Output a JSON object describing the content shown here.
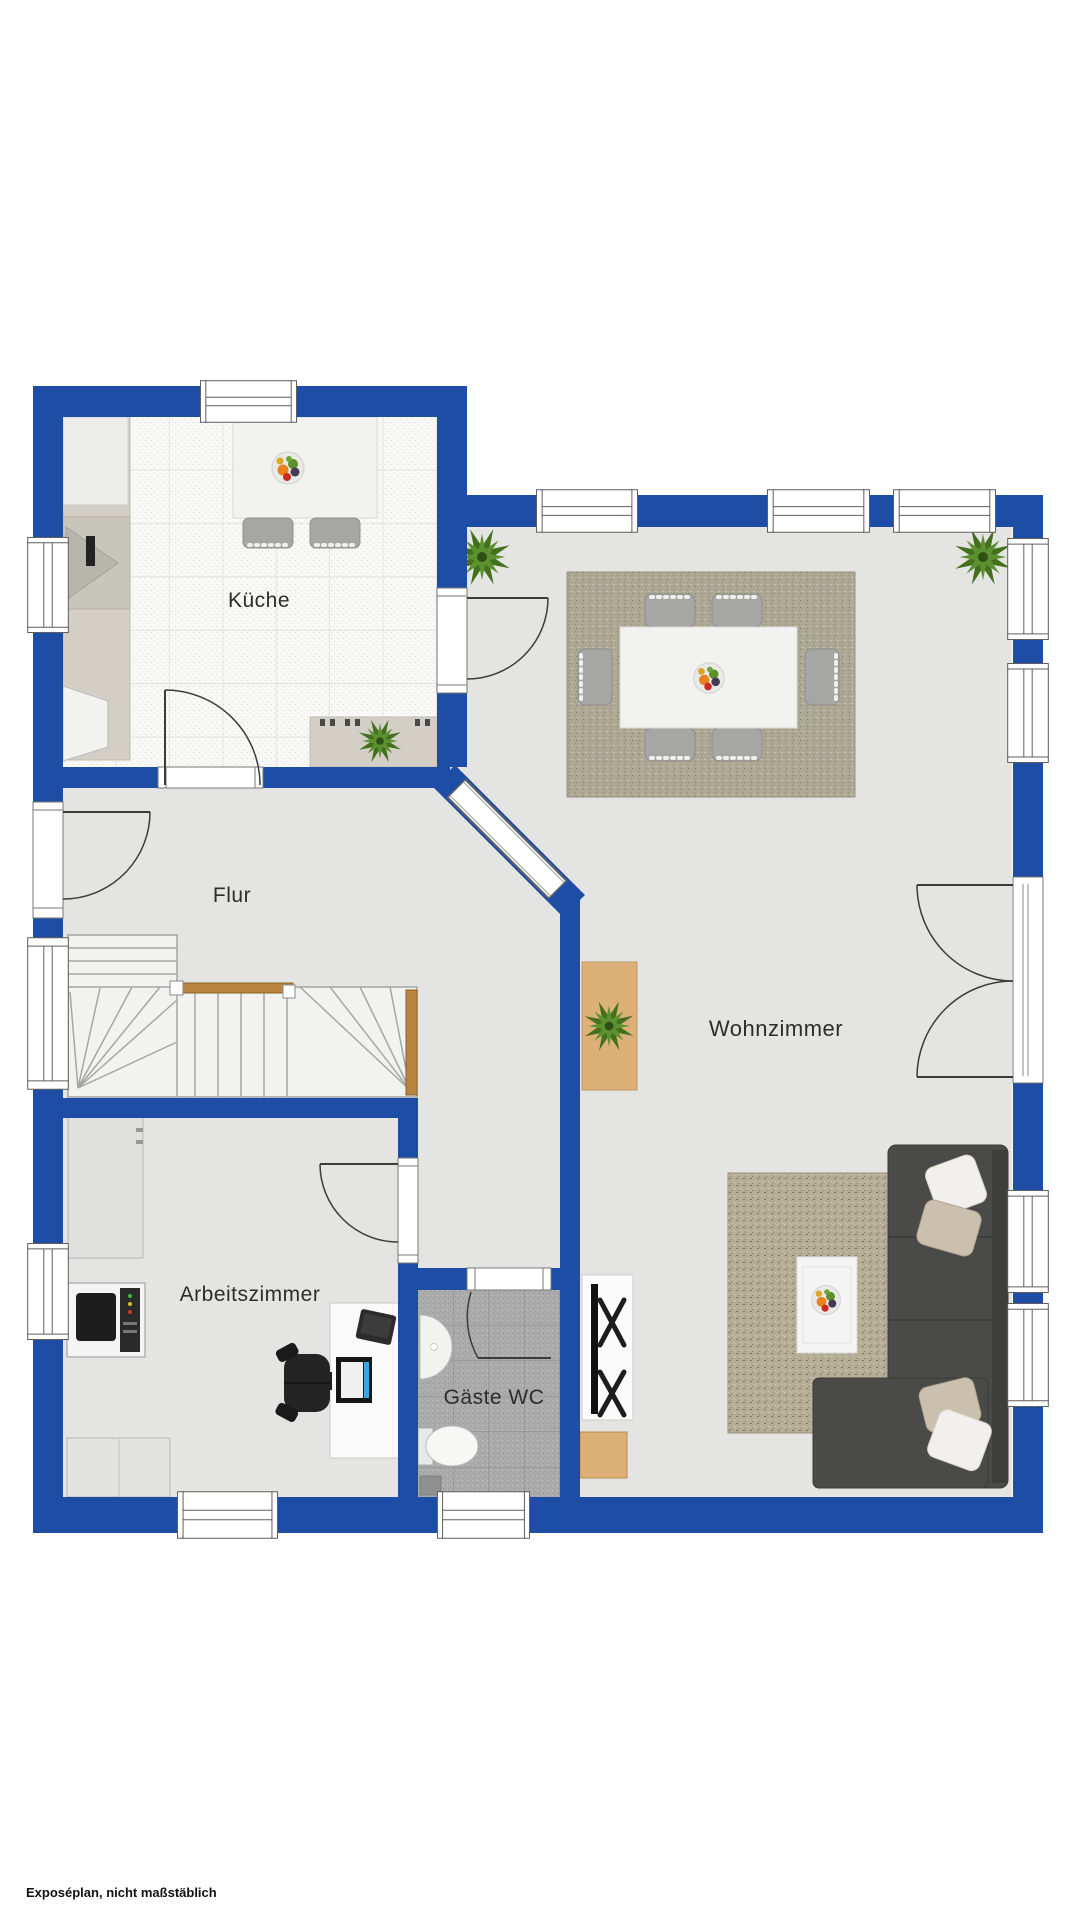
{
  "floorplan": {
    "title": "Erdgeschoss Grundriss",
    "rooms": [
      {
        "id": "kueche",
        "label": "Küche"
      },
      {
        "id": "flur",
        "label": "Flur"
      },
      {
        "id": "wohnzimmer",
        "label": "Wohnzimmer"
      },
      {
        "id": "arbeitszimmer",
        "label": "Arbeitszimmer"
      },
      {
        "id": "gaeste-wc",
        "label": "Gäste WC"
      }
    ],
    "footer_note": "Exposéplan, nicht maßstäblich",
    "colors": {
      "wall": "#1e4da6",
      "floor": "#e4e4e3",
      "kitchen_tile": "#f8f8f7",
      "wc_tile": "#ababab",
      "rug_dining": "#aca894",
      "rug_living": "#b6ad96",
      "stairs": "#f2f2f1",
      "handrail": "#b9853e",
      "couch": "#4a4a48",
      "couch_dark": "#3e3e3c",
      "wood": "#dcb078",
      "screen_accent": "#3aa7e0"
    }
  }
}
